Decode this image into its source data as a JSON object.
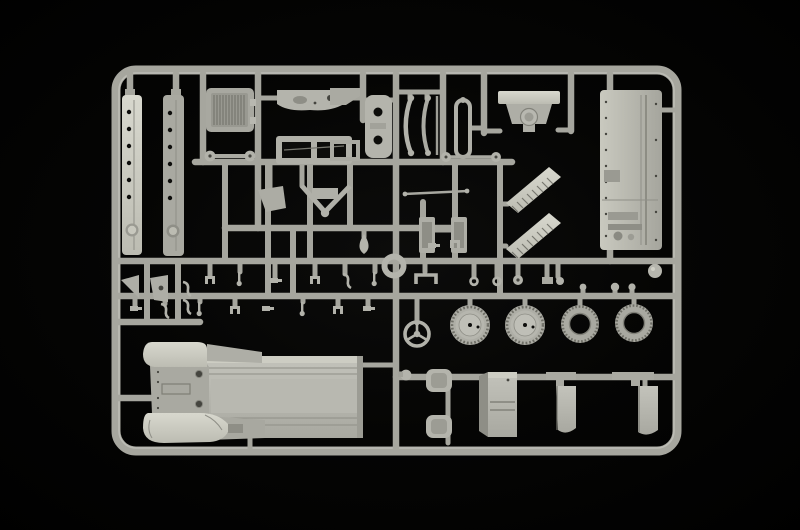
{
  "scene": {
    "type": "photograph",
    "subject": "plastic-model-kit-sprue",
    "description": "Light grey injection-moulded polystyrene sprue (parts tree) of a military truck model kit photographed on a plain black background",
    "orientation": "landscape",
    "text_visible": "none",
    "colors": {
      "background": "#000000",
      "background_center": "#0c0c0b",
      "runner": "#a6a69e",
      "runner_highlight": "#c2c2ba",
      "plastic": "#b2b2aa",
      "plastic_light": "#d2d2c8",
      "plastic_mid": "#a9a9a1",
      "plastic_dark": "#8e8e86",
      "detail_dark": "#45453f",
      "hole_black": "#0d0d0b"
    },
    "frame": {
      "shape": "rounded-rectangle",
      "corner_radius_px": 20,
      "approx_bounds_px": {
        "left": 112,
        "top": 66,
        "right": 681,
        "bottom": 455
      }
    },
    "inventory": {
      "road_wheels_with_hub": 2,
      "open_centre_tyres": 2,
      "steering_wheel_spokes": 3,
      "long_riveted_strips": 2,
      "louvered_side_panels": 2,
      "seat_shells": 2,
      "mudflap_brackets": 2,
      "approx_total_parts": 60
    },
    "parts": [
      {
        "name": "side-strip-a",
        "kind": "long riveted side rail, pale grey"
      },
      {
        "name": "side-strip-b",
        "kind": "long riveted side rail, mid grey"
      },
      {
        "name": "radiator-grille",
        "kind": "slatted radiator grille"
      },
      {
        "name": "dashboard-panel",
        "kind": "instrument panel with openings"
      },
      {
        "name": "window-frame-part",
        "kind": "twin-opening frame"
      },
      {
        "name": "mounting-plate",
        "kind": "plate with two round holes"
      },
      {
        "name": "leaf-springs",
        "kind": "pair of curved leaf springs"
      },
      {
        "name": "spring-frame",
        "kind": "narrow oval shackle frame"
      },
      {
        "name": "firewall-bellhousing",
        "kind": "engine bulkhead with circular hub"
      },
      {
        "name": "bed-side-panel",
        "kind": "large riveted cargo-bed panel with latch detail"
      },
      {
        "name": "axle-barbells",
        "kind": "axles with round hub ends"
      },
      {
        "name": "tie-rod",
        "kind": "thin steering rod"
      },
      {
        "name": "v-tow-frame",
        "kind": "V-shaped towing frame"
      },
      {
        "name": "louver-fender-a",
        "kind": "slanted louvered engine side panel"
      },
      {
        "name": "louver-fender-b",
        "kind": "slanted louvered engine side panel"
      },
      {
        "name": "ring-part",
        "kind": "spare wheel ring"
      },
      {
        "name": "steering-wheel",
        "kind": "three-spoke steering wheel"
      },
      {
        "name": "wheel-1",
        "kind": "road wheel with solid hub"
      },
      {
        "name": "wheel-2",
        "kind": "road wheel with solid hub"
      },
      {
        "name": "tyre-1",
        "kind": "treaded tyre, open centre"
      },
      {
        "name": "tyre-2",
        "kind": "treaded tyre, open centre"
      },
      {
        "name": "chassis-assembly",
        "kind": "largest part: cab front, rounded mudguards and ribbed flat bed"
      },
      {
        "name": "seat-shells",
        "kind": "two curved seat shells"
      },
      {
        "name": "stowage-box",
        "kind": "rectangular stowage box"
      },
      {
        "name": "mudflap-a",
        "kind": "mudflap with mounting bracket"
      },
      {
        "name": "mudflap-b",
        "kind": "mudflap with mounting bracket"
      },
      {
        "name": "gussets",
        "kind": "two triangular gusset plates"
      },
      {
        "name": "small-fittings",
        "kind": "numerous levers, clamps, hooks and washers on inner runners"
      }
    ]
  }
}
